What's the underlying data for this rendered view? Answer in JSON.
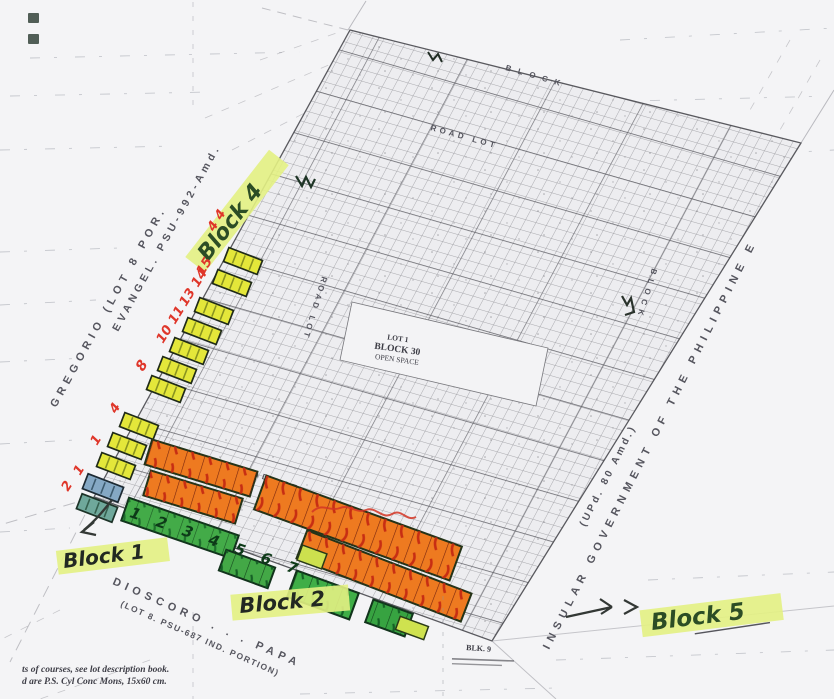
{
  "annotations": {
    "block4_label": "Block 4",
    "block1_label": "Block 1",
    "block2_label": "Block 2",
    "block5_label": "Block 5",
    "block1_lot_numbers": "1 2 3 4 5 6 7",
    "red_lot_numbers": [
      "2",
      "1",
      "1",
      "4",
      "8",
      "10 11",
      "13 14",
      "15",
      "4 4"
    ]
  },
  "map": {
    "open_space": {
      "lot": "LOT 1",
      "block": "BLOCK 30",
      "name": "OPEN SPACE"
    },
    "blk9_label": "BLK. 9",
    "owner_west": {
      "line1": "GREGORIO (LOT 8 POR.",
      "line2": "EVANGEL. PSU-992-Amd."
    },
    "owner_east": {
      "line1": "INSULAR GOVERNMENT OF THE PHILIPPINE E",
      "line2": "(UPd. 80 Amd.)"
    },
    "owner_south": {
      "line1": "DIOSCORO . . . PAPA",
      "line2": "(LOT 8. PSU-687 IND. PORTION)"
    },
    "road_label": "ROAD LOT",
    "block_label": "BLOCK"
  },
  "footnotes": {
    "line1": "ts of courses, see lot description book.",
    "line2": "d are P.S. Cyl Conc Mons, 15x60 cm."
  },
  "colors": {
    "marker_yellow_green": "#e3f183",
    "highlight_yellow": "#e4e73a",
    "highlight_orange": "#ee7a20",
    "highlight_green": "#43ab48",
    "highlight_blue": "#85a8c4",
    "ink_red": "#df362a",
    "ink_green": "#274420"
  }
}
